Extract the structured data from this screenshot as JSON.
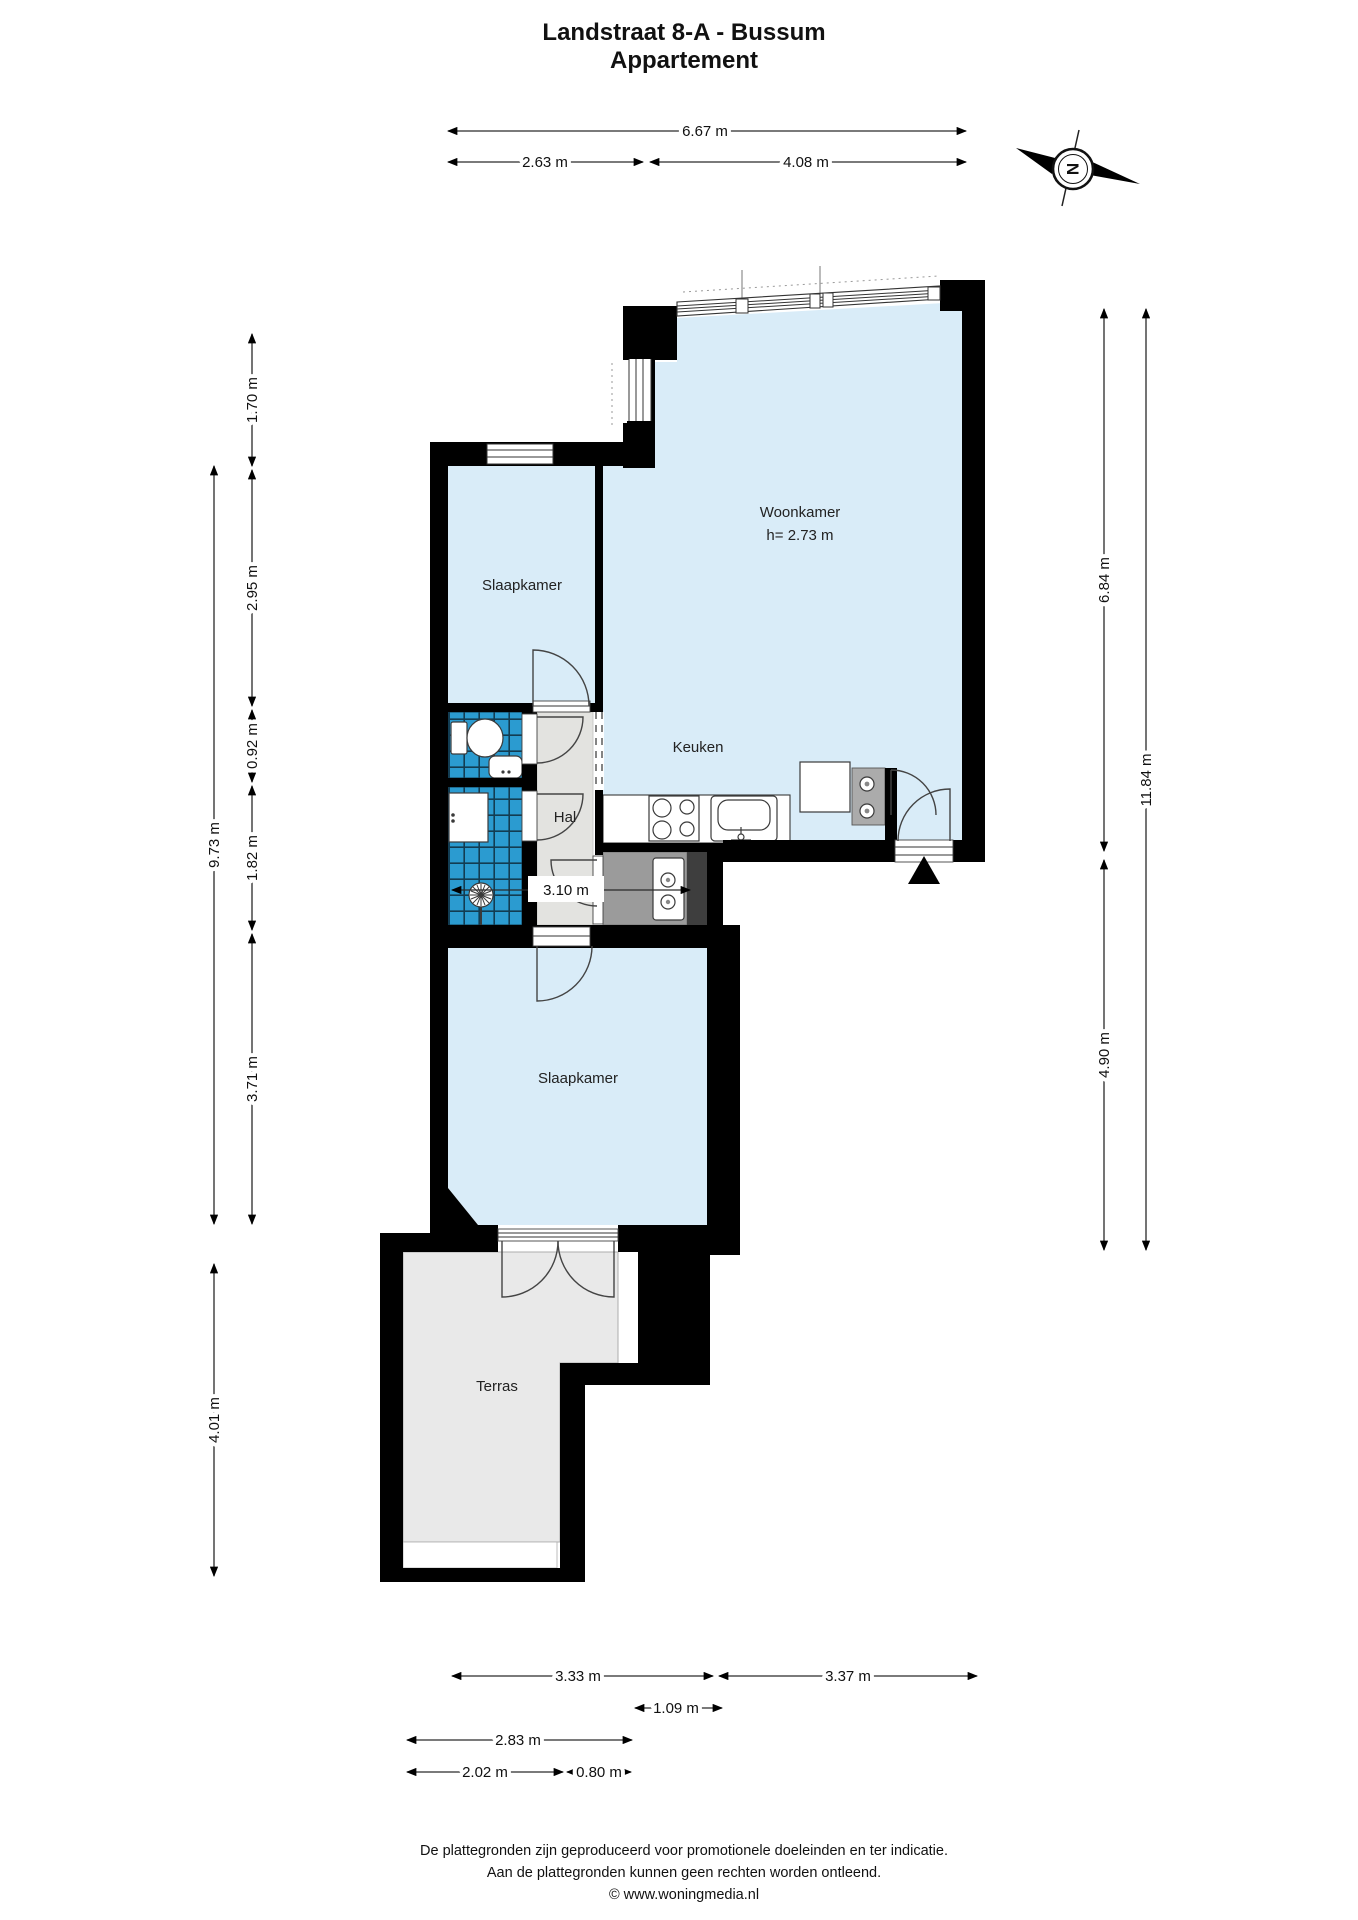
{
  "title": {
    "line1": "Landstraat 8-A - Bussum",
    "line2": "Appartement"
  },
  "compass": {
    "label": "N"
  },
  "rooms": {
    "woonkamer": {
      "label": "Woonkamer",
      "height_note": "h= 2.73 m"
    },
    "slaapkamer_boven": {
      "label": "Slaapkamer"
    },
    "keuken": {
      "label": "Keuken"
    },
    "hal": {
      "label": "Hal"
    },
    "slaapkamer_onder": {
      "label": "Slaapkamer"
    },
    "terras": {
      "label": "Terras"
    }
  },
  "dimensions": {
    "top_total": "6.67 m",
    "top_left": "2.63 m",
    "top_right": "4.08 m",
    "left_1": "1.70 m",
    "left_2": "2.95 m",
    "left_3": "0.92 m",
    "left_4": "1.82 m",
    "left_5": "3.71 m",
    "left_total": "9.73 m",
    "left_terras": "4.01 m",
    "right_upper": "6.84 m",
    "right_lower": "4.90 m",
    "right_total": "11.84 m",
    "bottom_1": "3.33 m",
    "bottom_2": "3.37 m",
    "bottom_3": "1.09 m",
    "bottom_4": "2.83 m",
    "bottom_5": "2.02 m",
    "bottom_6": "0.80 m",
    "hal_width": "3.10 m"
  },
  "colors": {
    "room_fill": "#d9ecf8",
    "tile_fill": "#2b9bd0",
    "hall_fill": "#e3e3e0",
    "terrace_fill": "#e9e9e9",
    "closet_fill": "#9b9b9b",
    "shaft_fill": "#3e3e3e",
    "wall": "#000000"
  },
  "footer": {
    "line1": "De plattegronden zijn geproduceerd voor promotionele doeleinden en ter indicatie.",
    "line2": "Aan de plattegronden kunnen geen rechten worden ontleend.",
    "line3": "© www.woningmedia.nl"
  }
}
